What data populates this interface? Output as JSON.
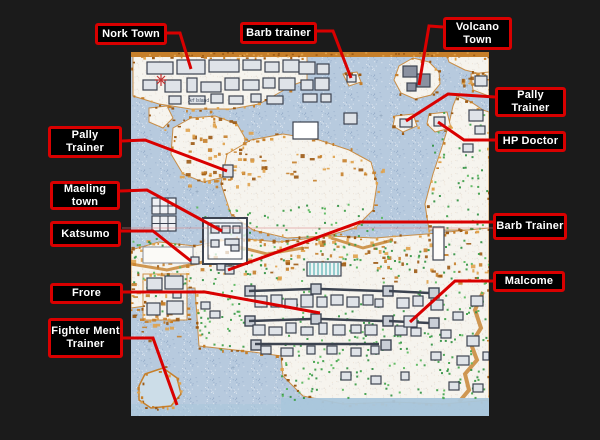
{
  "scene": {
    "description": "Annotated game world map with red callout labels marking towns and NPC trainers"
  },
  "palette": {
    "background": "#1b1b1b",
    "box_bg": "#000000",
    "box_border": "#d90000",
    "box_text": "#ffffff",
    "leader_line": "#d90000",
    "faint_line": "#d98080",
    "water": "#b7cade",
    "deep_water": "#a9c6db",
    "land": "#f6f4ee",
    "coast_orange": "#c67f2a",
    "coast_orange_dark": "#9c5a14",
    "coast_orange_light": "#e0a24b",
    "vegetation": "#3a9d44",
    "vegetation_dark": "#2e8f3e",
    "vegetation_light": "#57b85a",
    "building_stroke": "#3c4350",
    "building_fill": "#dfe3e8",
    "teal": "#7fc4c4",
    "marker_red": "#c03030",
    "island_fill": "#ccdde8"
  },
  "labels": [
    {
      "id": "nork-town",
      "lines": [
        "Nork Town"
      ],
      "box": {
        "left": 95,
        "top": 23,
        "width": 72,
        "height": 22
      },
      "line": [
        [
          167,
          33
        ],
        [
          180,
          33
        ],
        [
          191,
          69
        ]
      ]
    },
    {
      "id": "barb-trainer-top",
      "lines": [
        "Barb trainer"
      ],
      "box": {
        "left": 240,
        "top": 22,
        "width": 77,
        "height": 22
      },
      "line": [
        [
          317,
          31
        ],
        [
          333,
          31
        ],
        [
          351,
          78
        ]
      ]
    },
    {
      "id": "volcano-town",
      "lines": [
        "Volcano",
        "Town"
      ],
      "box": {
        "left": 443,
        "top": 17,
        "width": 69,
        "height": 33
      },
      "line": [
        [
          443,
          27
        ],
        [
          429,
          26
        ],
        [
          419,
          85
        ]
      ]
    },
    {
      "id": "pally-trainer-right",
      "lines": [
        "Pally",
        "Trainer"
      ],
      "box": {
        "left": 495,
        "top": 87,
        "width": 71,
        "height": 30
      },
      "line": [
        [
          495,
          97
        ],
        [
          448,
          94
        ],
        [
          406,
          121
        ]
      ]
    },
    {
      "id": "hp-doctor",
      "lines": [
        "HP Doctor"
      ],
      "box": {
        "left": 495,
        "top": 131,
        "width": 71,
        "height": 21
      },
      "line": [
        [
          495,
          140
        ],
        [
          464,
          140
        ],
        [
          438,
          122
        ]
      ]
    },
    {
      "id": "pally-trainer-left",
      "lines": [
        "Pally",
        "Trainer"
      ],
      "box": {
        "left": 48,
        "top": 126,
        "width": 74,
        "height": 32
      },
      "line": [
        [
          122,
          141
        ],
        [
          145,
          140
        ],
        [
          227,
          171
        ]
      ]
    },
    {
      "id": "maeling-town",
      "lines": [
        "Maeling",
        "town"
      ],
      "box": {
        "left": 50,
        "top": 181,
        "width": 70,
        "height": 29
      },
      "line": [
        [
          120,
          191
        ],
        [
          147,
          190
        ],
        [
          222,
          231
        ]
      ]
    },
    {
      "id": "katsumo",
      "lines": [
        "Katsumo"
      ],
      "box": {
        "left": 50,
        "top": 221,
        "width": 71,
        "height": 26
      },
      "line": [
        [
          121,
          231
        ],
        [
          153,
          231
        ],
        [
          191,
          261
        ]
      ]
    },
    {
      "id": "barb-trainer-right",
      "lines": [
        "Barb Trainer"
      ],
      "box": {
        "left": 493,
        "top": 213,
        "width": 74,
        "height": 27
      },
      "line": [
        [
          493,
          222
        ],
        [
          360,
          222
        ],
        [
          228,
          270
        ]
      ]
    },
    {
      "id": "malcome",
      "lines": [
        "Malcome"
      ],
      "box": {
        "left": 493,
        "top": 271,
        "width": 72,
        "height": 21
      },
      "line": [
        [
          493,
          281
        ],
        [
          455,
          281
        ],
        [
          410,
          322
        ]
      ]
    },
    {
      "id": "frore",
      "lines": [
        "Frore"
      ],
      "box": {
        "left": 50,
        "top": 283,
        "width": 73,
        "height": 21
      },
      "line": [
        [
          123,
          292
        ],
        [
          205,
          292
        ],
        [
          320,
          313
        ]
      ]
    },
    {
      "id": "fighter-ment-trainer",
      "lines": [
        "Fighter Ment",
        "Trainer"
      ],
      "box": {
        "left": 48,
        "top": 318,
        "width": 75,
        "height": 40
      },
      "line": [
        [
          123,
          338
        ],
        [
          153,
          338
        ],
        [
          177,
          405
        ]
      ]
    }
  ],
  "faint_line": [
    [
      122,
      228
    ],
    [
      493,
      228
    ]
  ],
  "map_annotations": [
    {
      "text": "Arf Island"
    }
  ]
}
